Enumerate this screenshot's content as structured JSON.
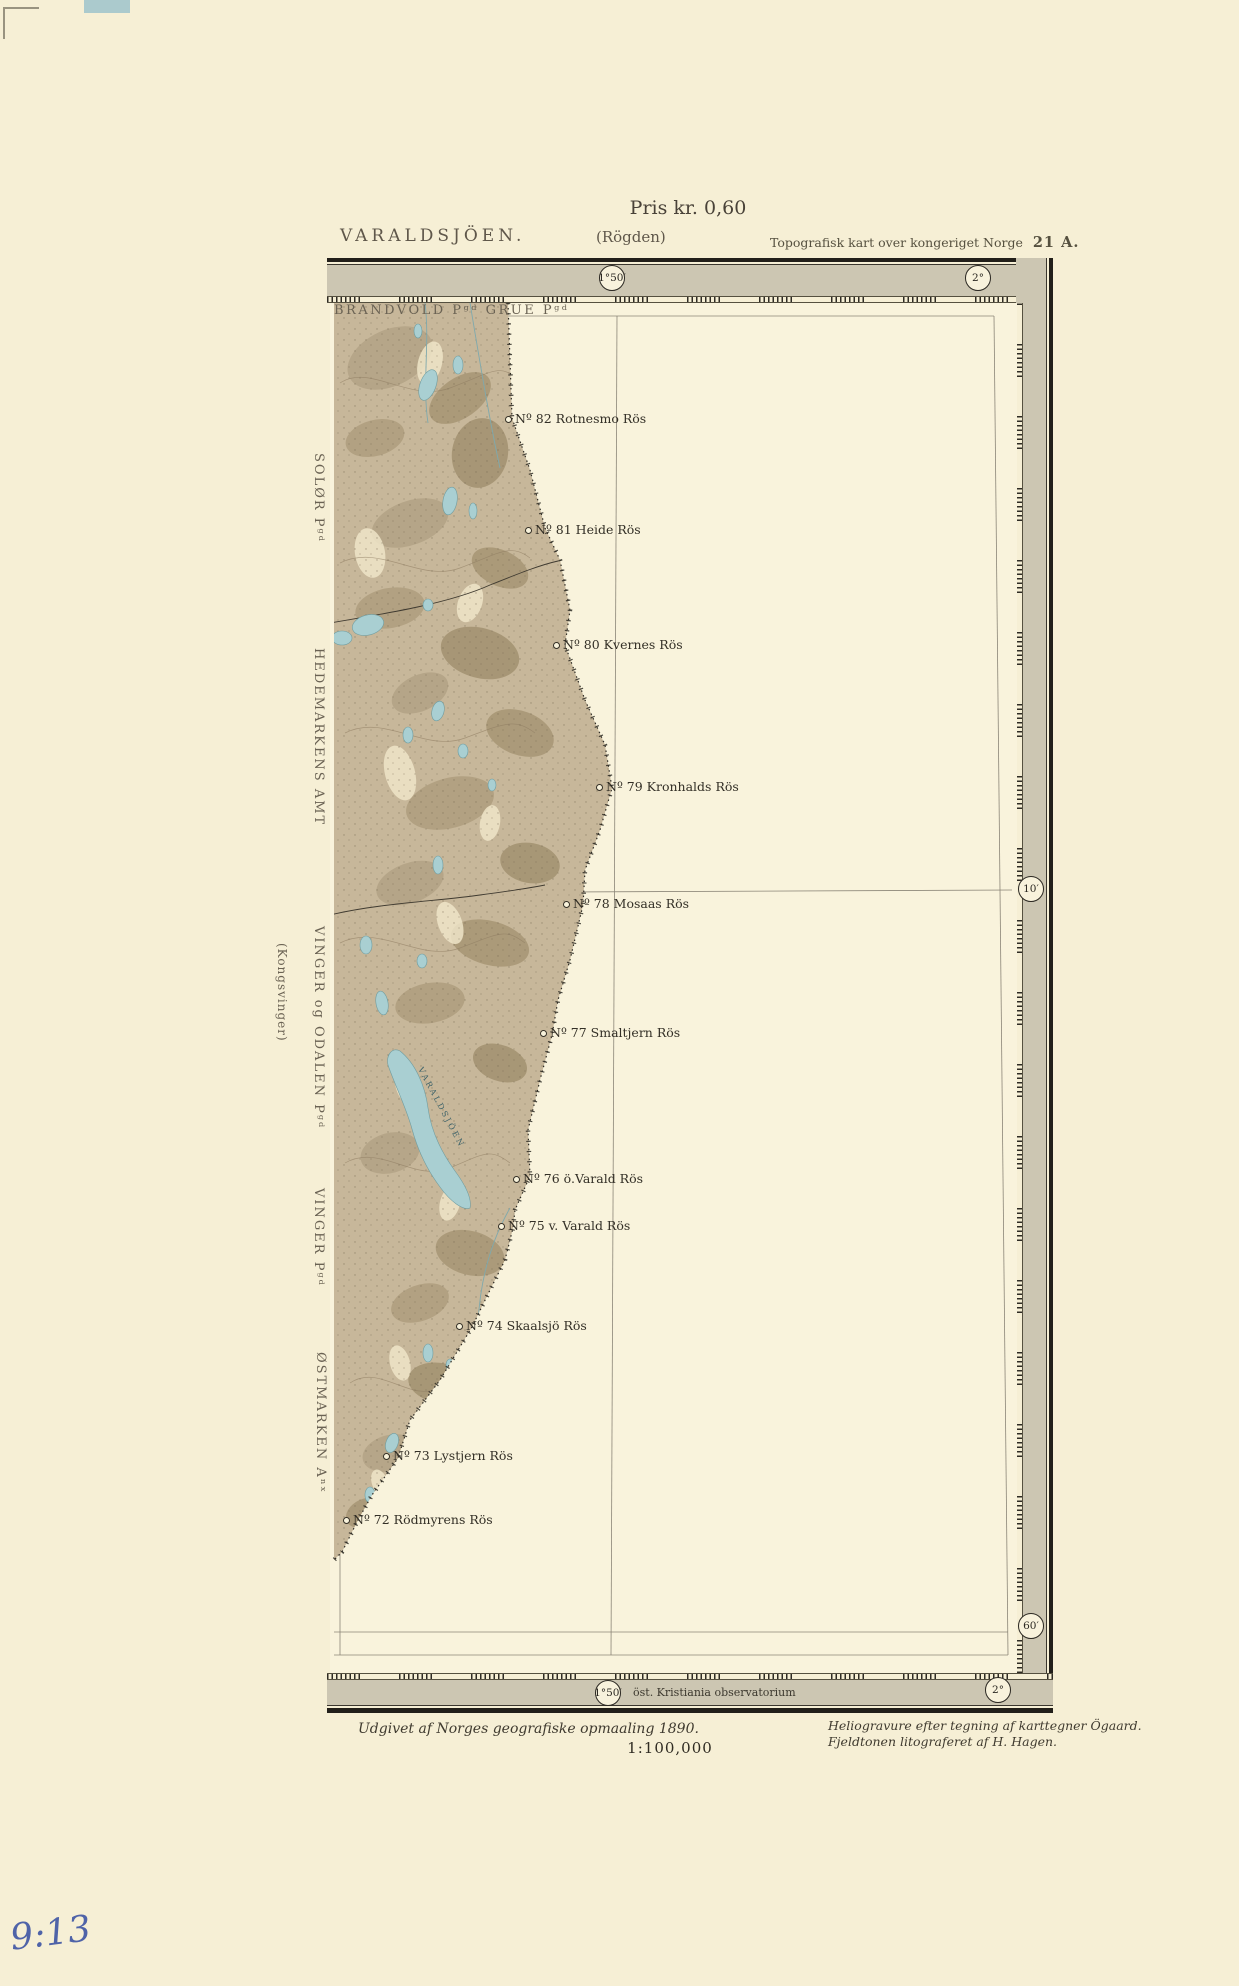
{
  "page": {
    "price": "Pris kr. 0,60"
  },
  "header": {
    "title": "VARALDSJÖEN.",
    "subtitle": "(Rögden)",
    "series": "Topografisk kart over kongeriget Norge",
    "sheet": "21 A."
  },
  "margin_labels": {
    "top": "BRANDVOLD Pᵍᵈ GRUE Pᵍᵈ",
    "solor": "SOLØR Pᵍᵈ",
    "amt": "HEDEMARKENS AMT",
    "vinger_odalen": "VINGER og ODALEN Pᵍᵈ",
    "kongsvinger": "(Kongsvinger)",
    "vinger": "VINGER Pᵍᵈ",
    "ostmarken": "ØSTMARKEN Aⁿˣ"
  },
  "graticule": {
    "top_left": "1°50′",
    "top_right": "2°",
    "right_upper": "10′",
    "right_lower": "60′",
    "bottom_left": "1°50′",
    "bottom_right": "2°",
    "bottom_note": "öst. Kristiania observatorium"
  },
  "cairns": [
    {
      "label": "Nº 82 Rotnesmo Rös"
    },
    {
      "label": "Nº 81 Heide Rös"
    },
    {
      "label": "Nº 80 Kvernes Rös"
    },
    {
      "label": "Nº 79 Kronhalds Rös"
    },
    {
      "label": "Nº 78 Mosaas Rös"
    },
    {
      "label": "Nº 77 Smaltjern Rös"
    },
    {
      "label": "Nº 76 ö.Varald Rös"
    },
    {
      "label": "Nº 75 v. Varald Rös"
    },
    {
      "label": "Nº 74 Skaalsjö Rös"
    },
    {
      "label": "Nº 73 Lystjern Rös"
    },
    {
      "label": "Nº 72 Rödmyrens Rös"
    }
  ],
  "map": {
    "lake_label": "VARALDSJÖEN"
  },
  "footer": {
    "publisher": "Udgivet af Norges geografiske opmaaling 1890.",
    "credit1": "Heliogravure efter tegning af karttegner Ögaard.",
    "credit2": "Fjeldtonen litograferet af H. Hagen.",
    "scale": "1:100,000"
  },
  "annotation": {
    "handwritten": "9:13"
  },
  "colors": {
    "paper": "#f6efd5",
    "band": "#ccc6b2",
    "frame": "#221f1a",
    "terrain": "#c7b79a",
    "lake": "#a9cfd2",
    "ink": "#332f26",
    "annotation_ink": "#4f63a8"
  }
}
